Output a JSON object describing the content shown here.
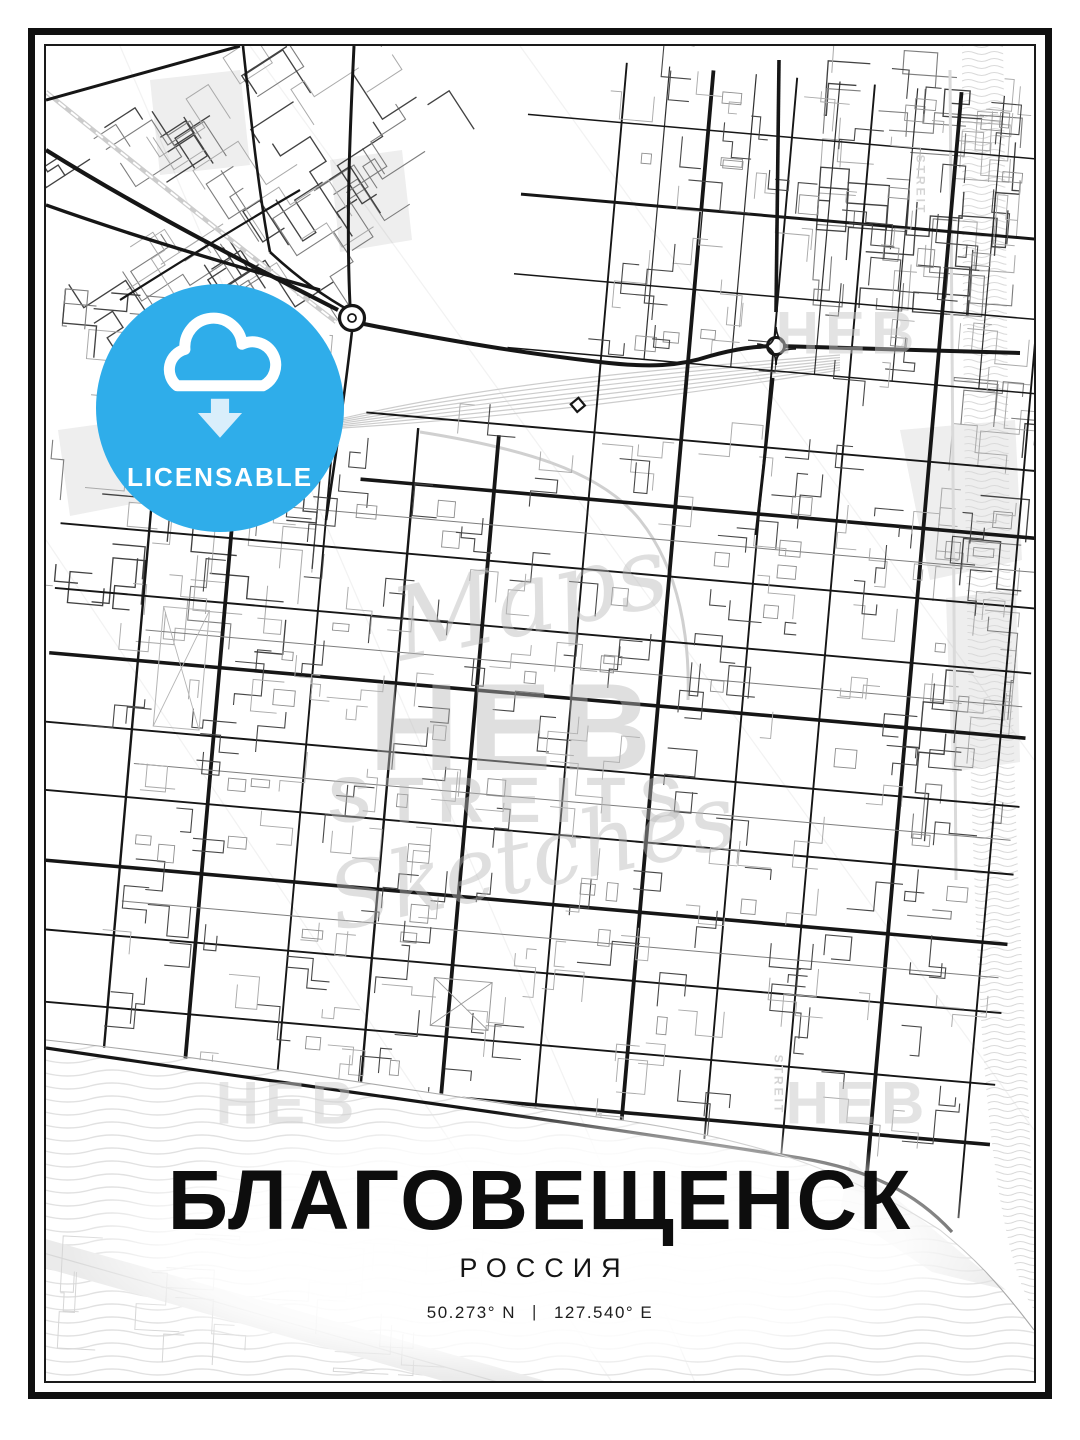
{
  "poster": {
    "title": "БЛАГОВЕЩЕНСК",
    "subtitle": "РОССИЯ",
    "coordinates": {
      "lat": "50.273° N",
      "divider": "|",
      "lon": "127.540° E"
    }
  },
  "badge": {
    "label": "LICENSABLE",
    "color": "#2fadea",
    "arrow_color": "#d9eefb",
    "icon": "cloud-download-icon"
  },
  "watermarks": {
    "script_top": "Maps",
    "block_center": "HEB",
    "block_mid": "STREITS",
    "script_bottom": "Sketches",
    "corner_top_right": "HEB",
    "corner_bottom_left": "HEB",
    "corner_bottom_right": "HEB",
    "vertical_top_right": "STREIT",
    "vertical_bottom_right": "STREIT"
  },
  "map_style": {
    "background": "#ffffff",
    "road_dark": "#161616",
    "road_mid": "#424242",
    "road_soft": "#7d7d7d",
    "road_light": "#aaaaaa",
    "rail": "#cccccc",
    "water_line": "#e1e1e1",
    "ripple_line": "#dadada",
    "park": "#eeeeee",
    "shore": "#a8a8a8",
    "crease": "rgba(0,0,0,0.05)"
  }
}
